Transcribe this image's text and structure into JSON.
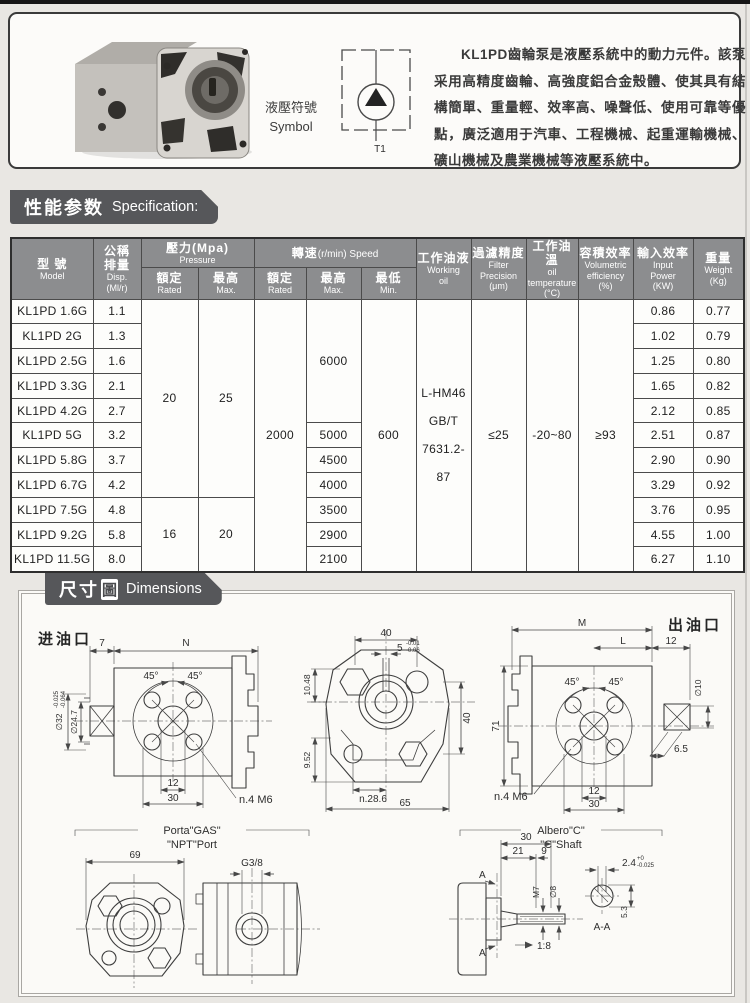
{
  "intro": {
    "symbol_label_zh": "液壓符號",
    "symbol_label_en": "Symbol",
    "symbol_port": "T1",
    "description": "KL1PD齒輪泵是液壓系統中的動力元件。該泵采用高精度齒輪、高強度鋁合金殼體、使其具有結構簡單、重量輕、效率高、噪聲低、使用可靠等優點，廣泛適用于汽車、工程機械、起重運輸機械、礦山機械及農業機械等液壓系統中。"
  },
  "spec": {
    "banner_zh": "性能参数",
    "banner_en": "Specification:",
    "header": {
      "model_zh": "型 號",
      "model_en": "Model",
      "disp_zh1": "公稱",
      "disp_zh2": "排量",
      "disp_en": "Disp.",
      "disp_unit": "(Ml/r)",
      "pressure_zh": "壓力(Mpa)",
      "pressure_en": "Pressure",
      "speed_zh": "轉速",
      "speed_en": "(r/min) Speed",
      "rated_zh": "額定",
      "rated_en": "Rated",
      "max_zh": "最高",
      "max_en": "Max.",
      "min_zh": "最低",
      "min_en": "Min.",
      "oil_zh": "工作油液",
      "oil_en1": "Working",
      "oil_en2": "oil",
      "filter_zh": "過濾精度",
      "filter_en1": "Filter",
      "filter_en2": "Precision",
      "filter_unit": "(μm)",
      "temp_zh": "工作油溫",
      "temp_en1": "oil",
      "temp_en2": "temperature",
      "temp_unit": "(°C)",
      "vol_zh": "容積效率",
      "vol_en1": "Volumetric",
      "vol_en2": "efficiency",
      "vol_unit": "(%)",
      "power_zh": "輸入效率",
      "power_en1": "Input",
      "power_en2": "Power",
      "power_unit": "(KW)",
      "weight_zh": "重量",
      "weight_en": "Weight",
      "weight_unit": "(Kg)"
    },
    "merged": {
      "pressure_rated_a": "20",
      "pressure_max_a": "25",
      "pressure_rated_b": "16",
      "pressure_max_b": "20",
      "speed_rated": "2000",
      "speed_max_a": "6000",
      "speed_min": "600",
      "oil_1": "L-HM46",
      "oil_2": "GB/T",
      "oil_3": "7631.2-87",
      "filter": "≤25",
      "temp": "-20~80",
      "vol": "≥93"
    },
    "rows": [
      {
        "model": "KL1PD 1.6G",
        "disp": "1.1",
        "power": "0.86",
        "weight": "0.77"
      },
      {
        "model": "KL1PD 2G",
        "disp": "1.3",
        "power": "1.02",
        "weight": "0.79"
      },
      {
        "model": "KL1PD 2.5G",
        "disp": "1.6",
        "power": "1.25",
        "weight": "0.80"
      },
      {
        "model": "KL1PD 3.3G",
        "disp": "2.1",
        "power": "1.65",
        "weight": "0.82"
      },
      {
        "model": "KL1PD 4.2G",
        "disp": "2.7",
        "power": "2.12",
        "weight": "0.85"
      },
      {
        "model": "KL1PD 5G",
        "disp": "3.2",
        "speed_max": "5000",
        "power": "2.51",
        "weight": "0.87"
      },
      {
        "model": "KL1PD 5.8G",
        "disp": "3.7",
        "speed_max": "4500",
        "power": "2.90",
        "weight": "0.90"
      },
      {
        "model": "KL1PD 6.7G",
        "disp": "4.2",
        "speed_max": "4000",
        "power": "3.29",
        "weight": "0.92"
      },
      {
        "model": "KL1PD 7.5G",
        "disp": "4.8",
        "speed_max": "3500",
        "power": "3.76",
        "weight": "0.95"
      },
      {
        "model": "KL1PD 9.2G",
        "disp": "5.8",
        "speed_max": "2900",
        "power": "4.55",
        "weight": "1.00"
      },
      {
        "model": "KL1PD 11.5G",
        "disp": "8.0",
        "speed_max": "2100",
        "power": "6.27",
        "weight": "1.10"
      }
    ]
  },
  "dims": {
    "banner_zh": "尺寸",
    "banner_box": "圖",
    "banner_en": "Dimensions",
    "inlet_label": "进油口",
    "outlet_label": "出油口",
    "inlet": {
      "d7": "7",
      "dN": "N",
      "a45l": "45°",
      "a45r": "45°",
      "d32": "∅32",
      "tol1": "-0.025",
      "tol2": "-0.064",
      "d247": "∅24.7",
      "d12": "12",
      "d30": "30",
      "n4m6": "n.4 M6"
    },
    "front": {
      "d40": "40",
      "d5": "5",
      "tol1": "-0.01",
      "tol2": "-0.06",
      "d1048": "10.48",
      "d952": "9.52",
      "d40r": "40",
      "n286": "n.28.6",
      "d65": "65"
    },
    "outlet": {
      "dM": "M",
      "dL": "L",
      "d12t": "12",
      "d71": "71",
      "d10": "∅10",
      "d65": "6.5",
      "a45l": "45°",
      "a45r": "45°",
      "d12": "12",
      "d30": "30",
      "n4m6": "n.4 M6"
    },
    "ports": {
      "t1": "Porta\"GAS\"",
      "t2": "\"NPT\"Port",
      "d69": "69",
      "g38": "G3/8"
    },
    "shaft": {
      "t1": "Albero\"C\"",
      "t2": "\"C\"Shaft",
      "d30": "30",
      "d21": "21",
      "d9": "9",
      "m7": "M7",
      "d8": "∅8",
      "taper": "1:8",
      "d24": "2.4",
      "tol1": "+0",
      "tol2": "-0.025",
      "d53": "5.3",
      "aa": "A-A",
      "a_top": "A",
      "a_bot": "A"
    }
  }
}
